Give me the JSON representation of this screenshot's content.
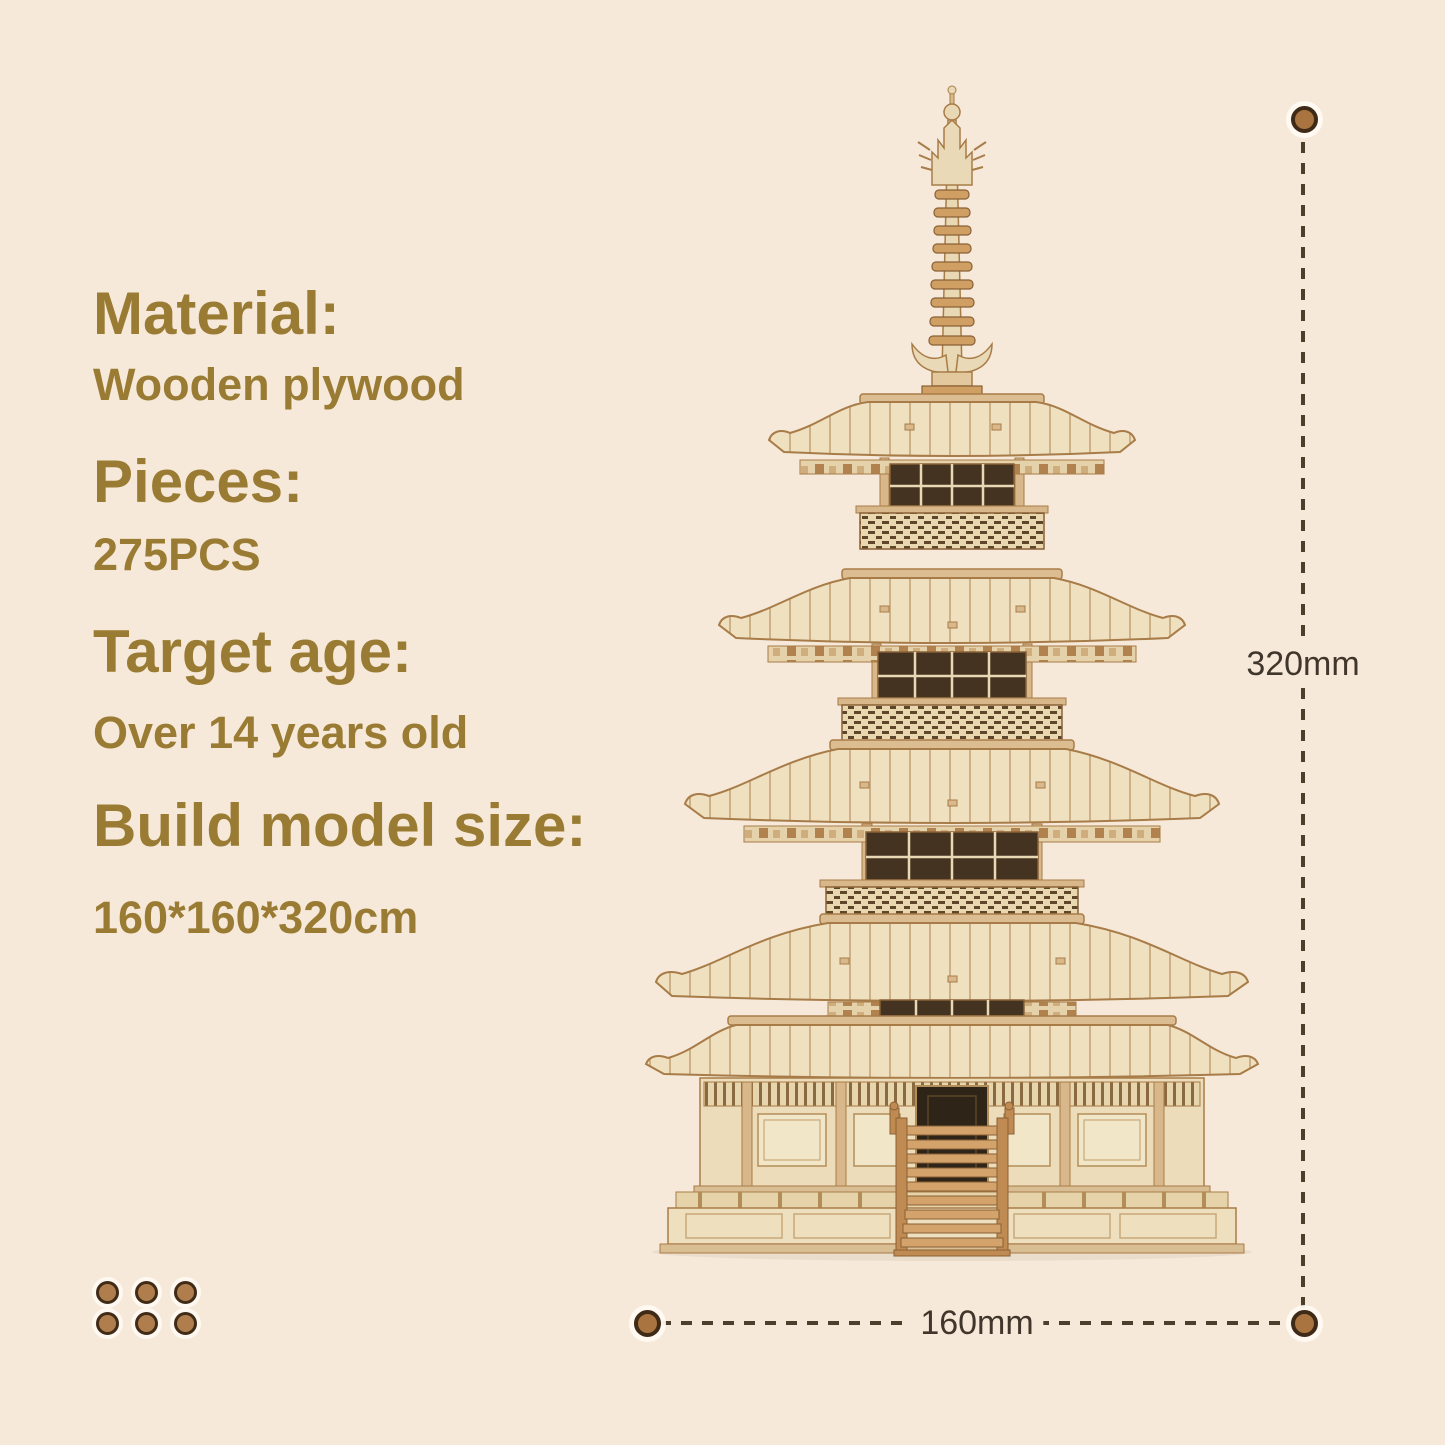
{
  "canvas": {
    "bg_color": "#f6e9d9"
  },
  "specs": {
    "text_color": "#9a7b33",
    "items": [
      {
        "heading": "Material:",
        "value": "Wooden plywood"
      },
      {
        "heading": "Pieces:",
        "value": "275PCS"
      },
      {
        "heading": "Target age:",
        "value": "Over 14 years old"
      },
      {
        "heading": "Build model size:",
        "value": "160*160*320cm"
      }
    ]
  },
  "dimension_annotations": {
    "height_label": "320mm",
    "width_label": "160mm",
    "line_color": "#4e3e2c",
    "label_color": "#40362b",
    "dot_color": "#a9743f"
  },
  "illustration": {
    "subject": "five-story wooden pagoda 3D puzzle model",
    "wood_light": "#efe0bf",
    "wood_mid": "#d3a36b",
    "wood_dark": "#a87c48",
    "opening_dark": "#2f2418"
  },
  "decoration": {
    "dot_count": 6,
    "dot_color": "#b07e4d"
  }
}
